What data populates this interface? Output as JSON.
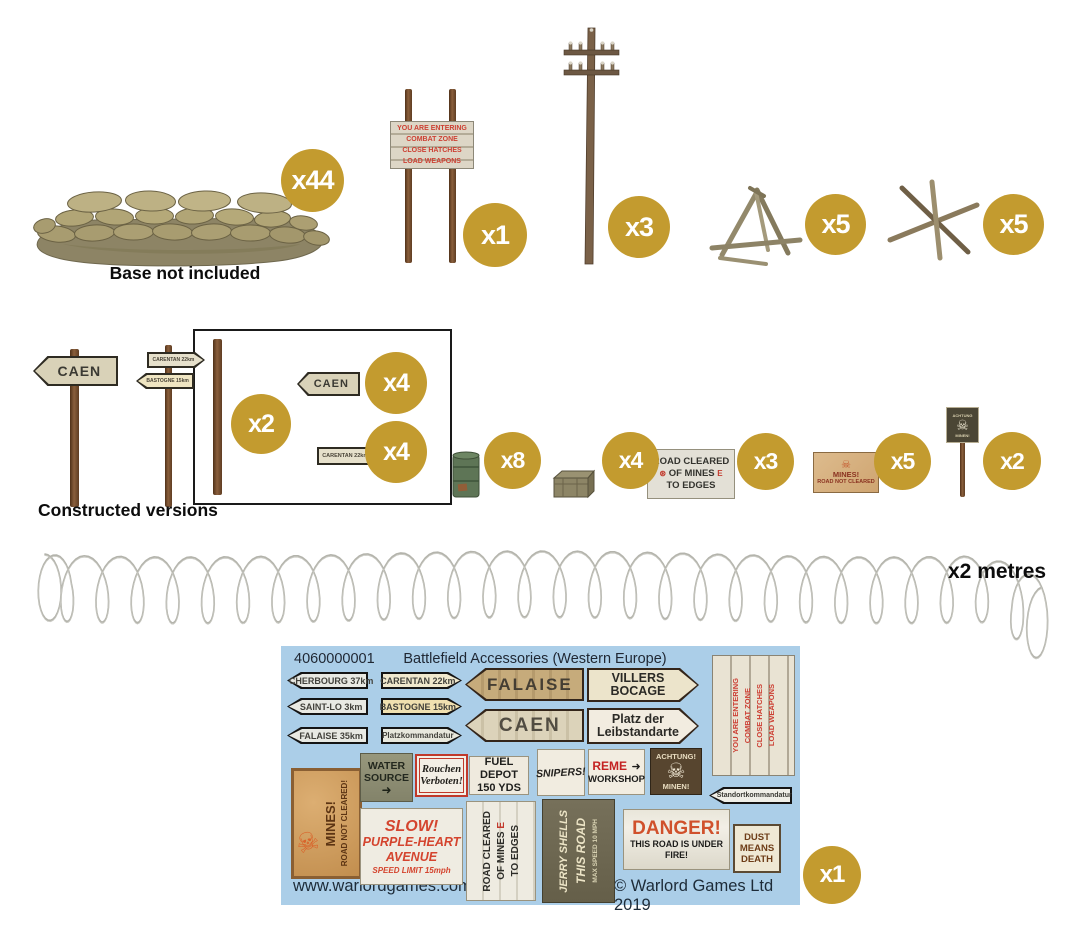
{
  "icons": {
    "skull": "☠",
    "arrow": "➜"
  },
  "top_row": {
    "sandbags": {
      "qty": "x44",
      "caption": "Base not included"
    },
    "warning_sign": {
      "qty": "x1",
      "lines": [
        "YOU ARE ENTERING",
        "COMBAT ZONE",
        "CLOSE HATCHES",
        "LOAD WEAPONS"
      ]
    },
    "telegraph_pole": {
      "qty": "x3"
    },
    "tripod_obstacle": {
      "qty": "x5"
    },
    "hedgehog_obstacle": {
      "qty": "x5"
    }
  },
  "middle_row": {
    "caption": "Constructed versions",
    "caen_signpost": {
      "label": "CAEN"
    },
    "double_signpost": {
      "top": "CARENTAN 22km",
      "bottom": "BASTOGNE 15km"
    },
    "sprue_box": {
      "pole_qty": "x2",
      "caen_label": "CAEN",
      "caen_qty": "x4",
      "carentan_label": "CARENTAN 22km",
      "carentan_qty": "x4"
    },
    "oil_drum": {
      "qty": "x8"
    },
    "crate": {
      "qty": "x4"
    },
    "road_cleared_sign": {
      "qty": "x3",
      "lines": [
        "ROAD CLEARED",
        "OF MINES",
        "TO EDGES"
      ]
    },
    "mines_sign": {
      "qty": "x5",
      "lines": [
        "MINES!",
        "ROAD NOT CLEARED"
      ]
    },
    "minefield_marker": {
      "qty": "x2",
      "top": "ACHTUNG",
      "bottom": "MINEN!"
    }
  },
  "wire": {
    "label": "x2 metres"
  },
  "sheet": {
    "code": "4060000001",
    "title": "Battlefield Accessories (Western Europe)",
    "qty": "x1",
    "website": "www.warlordgames.com",
    "copyright": "© Warlord Games Ltd 2019",
    "small_left_arrows": [
      "CHERBOURG 37km",
      "SAINT-LO 3km",
      "FALAISE 35km"
    ],
    "small_right_arrows": [
      "CARENTAN 22km",
      "BASTOGNE 15km",
      "Platzkommandatur"
    ],
    "big_left_arrows": [
      "FALAISE",
      "CAEN"
    ],
    "big_right_arrows": [
      {
        "line1": "VILLERS",
        "line2": "BOCAGE"
      },
      {
        "line1": "Platz der",
        "line2": "Leibstandarte"
      }
    ],
    "combat_sign_lines": [
      "YOU ARE ENTERING",
      "COMBAT ZONE",
      "CLOSE HATCHES",
      "LOAD WEAPONS"
    ],
    "standort_arrow": "Standortkommandatur",
    "mines_poster": {
      "line1": "MINES!",
      "line2": "ROAD NOT CLEARED!"
    },
    "water_source": {
      "line1": "WATER",
      "line2": "SOURCE"
    },
    "rauchen": {
      "line1": "Rouchen",
      "line2": "Verboten!"
    },
    "fuel_depot": {
      "line1": "FUEL DEPOT",
      "line2": "150 YDS"
    },
    "snipers": "SNIPERS!",
    "reme": {
      "red": "REME",
      "line2": "WORKSHOP"
    },
    "achtung": {
      "line1": "ACHTUNG!",
      "line2": "MINEN!"
    },
    "slow": {
      "line1": "SLOW!",
      "line2": "PURPLE-HEART",
      "line3": "AVENUE",
      "line4": "SPEED LIMIT 15mph"
    },
    "road_cleared": {
      "col1": "ROAD CLEARED",
      "col2": "OF MINES",
      "col2_accent": "E",
      "col3": "TO EDGES"
    },
    "jerry": {
      "col1": "JERRY SHELLS",
      "col2": "THIS ROAD",
      "col3": "MAX SPEED 10 MPH"
    },
    "danger": {
      "title": "DANGER!",
      "sub": "THIS ROAD IS UNDER FIRE!"
    },
    "dust": {
      "line1": "DUST",
      "line2": "MEANS",
      "line3": "DEATH"
    }
  }
}
